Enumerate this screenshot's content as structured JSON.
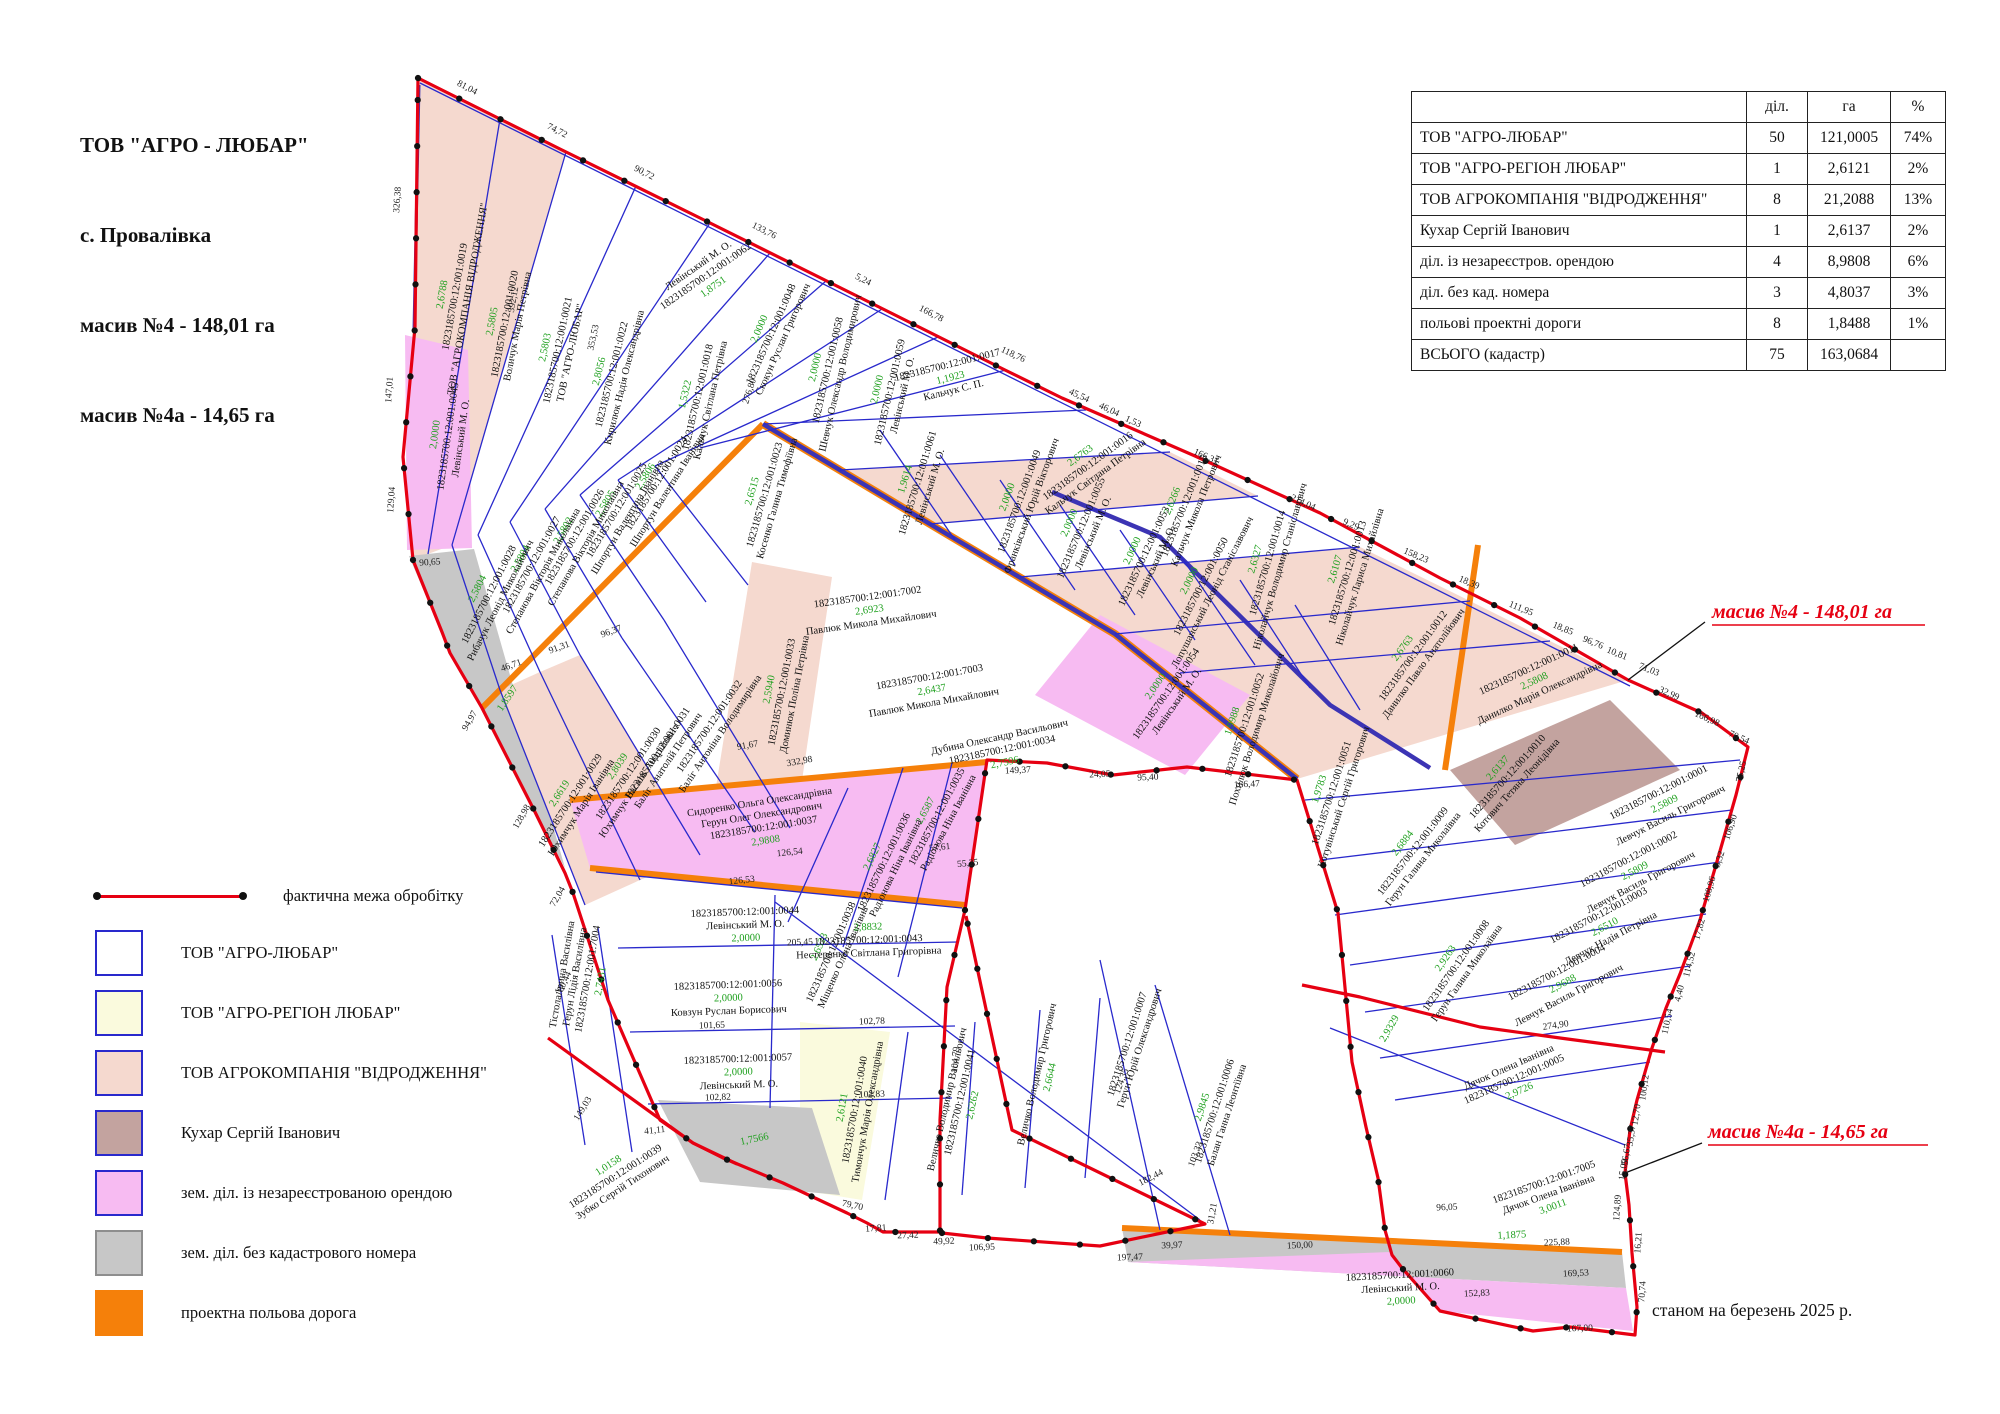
{
  "title_block": {
    "company": "ТОВ \"АГРО - ЛЮБАР\"",
    "village": "с. Провалівка",
    "massif4": "масив №4 - 148,01 га",
    "massif4a": "масив №4а - 14,65 га"
  },
  "summary_table": {
    "columns": [
      "діл.",
      "га",
      "%"
    ],
    "rows": [
      {
        "name": "ТОВ \"АГРО-ЛЮБАР\"",
        "plots": "50",
        "area": "121,0005",
        "pct": "74%"
      },
      {
        "name": "ТОВ \"АГРО-РЕГІОН ЛЮБАР\"",
        "plots": "1",
        "area": "2,6121",
        "pct": "2%"
      },
      {
        "name": "ТОВ АГРОКОМПАНІЯ \"ВІДРОДЖЕННЯ\"",
        "plots": "8",
        "area": "21,2088",
        "pct": "13%"
      },
      {
        "name": "Кухар Сергій Іванович",
        "plots": "1",
        "area": "2,6137",
        "pct": "2%"
      },
      {
        "name": "діл. із незареєстров. орендою",
        "plots": "4",
        "area": "8,9808",
        "pct": "6%"
      },
      {
        "name": "діл. без кад. номера",
        "plots": "3",
        "area": "4,8037",
        "pct": "3%"
      },
      {
        "name": "польові проектні дороги",
        "plots": "8",
        "area": "1,8488",
        "pct": "1%"
      },
      {
        "name": "ВСЬОГО (кадастр)",
        "plots": "75",
        "area": "163,0684",
        "pct": ""
      }
    ]
  },
  "legend": {
    "line_item": "фактична межа обробітку",
    "items": [
      {
        "label": "ТОВ \"АГРО-ЛЮБАР\"",
        "color": "#ffffff",
        "border": "#2929cc"
      },
      {
        "label": "ТОВ \"АГРО-РЕГІОН ЛЮБАР\"",
        "color": "#fafadd",
        "border": "#2929cc"
      },
      {
        "label": "ТОВ АГРОКОМПАНІЯ \"ВІДРОДЖЕННЯ\"",
        "color": "#f5d9cf",
        "border": "#2929cc"
      },
      {
        "label": "Кухар Сергій Іванович",
        "color": "#c3a39f",
        "border": "#2929cc"
      },
      {
        "label": "зем. діл. із незареєстрованою орендою",
        "color": "#f7bbf2",
        "border": "#2929cc"
      },
      {
        "label": "зем. діл. без кадастрового номера",
        "color": "#c7c7c7",
        "border": "#8e8e8e"
      },
      {
        "label": "проектна польова дорога",
        "color": "#f5800a",
        "border": "#f5800a"
      }
    ]
  },
  "annotations": {
    "massif4_label": "масив №4 - 148,01 га",
    "massif4a_label": "масив №4а - 14,65 га",
    "date_note": "станом на березень 2025 р."
  },
  "colors": {
    "boundary": "#e60012",
    "parcel_line": "#2929cc",
    "road": "#f5800a",
    "vidrodzhennia": "#f5d9cf",
    "region": "#fafadd",
    "kuhar": "#c3a39f",
    "unreg": "#f7bbf2",
    "nocad": "#c7c7c7",
    "area_text": "#1fa01f"
  },
  "parcels": [
    {
      "id": "1823185700:12:001:0019",
      "owner": "ТОВ \"АГРОКОМПАНІЯ ВІДРОДЖЕННЯ\"",
      "area": "2,6788",
      "cat": "vidrodzhennia"
    },
    {
      "id": "1823185700:12:001:0020",
      "owner": "Воличук Марія Петрівна",
      "area": "2,5805",
      "cat": "vidrodzhennia"
    },
    {
      "id": "1823185700:12:001:0021",
      "owner": "ТОВ \"АГРО-ЛЮБАР\"",
      "area": "2,5803",
      "cat": "lyubar"
    },
    {
      "id": "1823185700:12:001:0022",
      "owner": "Кирилюк Надія Олександрівна",
      "area": "2,8056",
      "cat": "lyubar"
    },
    {
      "id": "1823185700:12:001:0062",
      "owner": "Левінський М. О.",
      "area": "1,8751",
      "cat": "lyubar"
    },
    {
      "id": "1823185700:12:001:0048",
      "owner": "Скокун Руслан Григорович",
      "area": "2,0000",
      "cat": "lyubar"
    },
    {
      "id": "1823185700:12:001:0058",
      "owner": "Шевчук Олександр Володимирович",
      "area": "2,0000",
      "cat": "lyubar"
    },
    {
      "id": "1823185700:12:001:0059",
      "owner": "Левінський М. О.",
      "area": "2,0000",
      "cat": "lyubar"
    },
    {
      "id": "1823185700:12:001:0017",
      "owner": "Кальчук С. П.",
      "area": "1,1923",
      "cat": "lyubar"
    },
    {
      "id": "1823185700:12:001:0016",
      "owner": "Кальчук Світлана Петрівна",
      "area": "2,6763",
      "cat": "lyubar"
    },
    {
      "id": "1823185700:12:001:0015",
      "owner": "Кальчук Микола Петрович",
      "area": "2,6266",
      "cat": "lyubar"
    },
    {
      "id": "1823185700:12:001:0014",
      "owner": "Ніколайчук Володимир Станіславович",
      "area": "2,6327",
      "cat": "vidrodzhennia"
    },
    {
      "id": "1823185700:12:001:0013",
      "owner": "Ніколайчук Лариса Михайлівна",
      "area": "2,6107",
      "cat": "lyubar"
    },
    {
      "id": "1823185700:12:001:0012",
      "owner": "Данилко Павло Анатолійович",
      "area": "2,6763",
      "cat": "vidrodzhennia"
    },
    {
      "id": "1823185700:12:001:0011",
      "owner": "Данилко Марія Олександрівна",
      "area": "2,5808",
      "cat": "vidrodzhennia"
    },
    {
      "id": "1823185700:12:001:0010",
      "owner": "Котович Тетяна Леонідівна",
      "area": "2,6137",
      "cat": "kuhar"
    },
    {
      "id": "1823185700:12:001:0018",
      "owner": "Кальчук Світлана Петрівна",
      "area": "1,5322",
      "cat": "lyubar"
    },
    {
      "id": "1823185700:12:001:0024",
      "owner": "Шпортун Валентина Іванівна",
      "area": "2,5806",
      "cat": "lyubar"
    },
    {
      "id": "1823185700:12:001:0025",
      "owner": "Шпортун Валентина Іванівна",
      "area": "2,5805",
      "cat": "lyubar"
    },
    {
      "id": "1823185700:12:001:0026",
      "owner": "Степанова Вікторія Миколаївна",
      "area": "2,5802",
      "cat": "lyubar"
    },
    {
      "id": "1823185700:12:001:0027",
      "owner": "Степанова Вікторія Миколаївна",
      "area": "2,5804",
      "cat": "lyubar"
    },
    {
      "id": "1823185700:12:001:0028",
      "owner": "Рибачук Леонід Миколайович",
      "area": "2,5804",
      "cat": "lyubar"
    },
    {
      "id": "1823185700:12:001:0023",
      "owner": "Косенко Галина Тимофіївна",
      "area": "2,6515",
      "cat": "lyubar"
    },
    {
      "id": "1823185700:12:001:0045",
      "owner": "Левінський М. О.",
      "area": "2,0000",
      "cat": "unreg"
    },
    {
      "id": "",
      "owner": "",
      "area": "1,8597",
      "cat": "nocad"
    },
    {
      "id": "1823185700:12:001:0029",
      "owner": "Юхимчук Марія Іванівна",
      "area": "2,6619",
      "cat": "vidrodzhennia"
    },
    {
      "id": "1823185700:12:001:0030",
      "owner": "Юхимчук Василь Андрійович",
      "area": "2,8039",
      "cat": "vidrodzhennia"
    },
    {
      "id": "1823185700:12:001:0031",
      "owner": "Баліг Анатолій Петрович",
      "area": "",
      "cat": "lyubar"
    },
    {
      "id": "1823185700:12:001:0032",
      "owner": "Баліг Антоніна Володимирівна",
      "area": "",
      "cat": "lyubar"
    },
    {
      "id": "1823185700:12:001:0033",
      "owner": "Доминюк Поліна Петрівна",
      "area": "2,5940",
      "cat": "vidrodzhennia"
    },
    {
      "id": "1823185700:12:001:7002",
      "owner": "Павлюк Микола Михайлович",
      "area": "2,6923",
      "cat": "lyubar"
    },
    {
      "id": "1823185700:12:001:7003",
      "owner": "Павлюк Микола Михайлович",
      "area": "2,6437",
      "cat": "lyubar"
    },
    {
      "id": "1823185700:12:001:0034",
      "owner": "Дубина Олександр Васильович",
      "area": "2,7596",
      "cat": "lyubar"
    },
    {
      "id": "1823185700:12:001:0061",
      "owner": "Левінський М. О.",
      "area": "1,9614",
      "cat": "lyubar"
    },
    {
      "id": "1823185700:12:001:0049",
      "owner": "Франківський Юрій Вікторович",
      "area": "2,0000",
      "cat": "lyubar"
    },
    {
      "id": "1823185700:12:001:0055",
      "owner": "Левінський М. О.",
      "area": "2,0000",
      "cat": "lyubar"
    },
    {
      "id": "1823185700:12:001:0053",
      "owner": "Левінський М. О.",
      "area": "2,0000",
      "cat": "lyubar"
    },
    {
      "id": "1823185700:12:001:0050",
      "owner": "Лопушанський Леонід Станіславович",
      "area": "2,0000",
      "cat": "lyubar"
    },
    {
      "id": "1823185700:12:001:0054",
      "owner": "Левінський М. О.",
      "area": "2,0000",
      "cat": "unreg"
    },
    {
      "id": "1823185700:12:001:0052",
      "owner": "Похилюк Володимир Миколайович",
      "area": "1,9988",
      "cat": "lyubar"
    },
    {
      "id": "1823185700:12:001:0051",
      "owner": "Котувінський Сергій Григорович",
      "area": "1,9783",
      "cat": "lyubar"
    },
    {
      "id": "1823185700:12:001:0037",
      "owner": "Сидоренко Ольга Олександрівна",
      "owner2": "Герун Олег Олександрович",
      "area": "2,9808",
      "cat": "unreg"
    },
    {
      "id": "1823185700:12:001:0035",
      "owner": "Радіонова Ніна Іванівна",
      "area": "2,6587",
      "cat": "lyubar"
    },
    {
      "id": "1823185700:12:001:0036",
      "owner": "Радіонова Ніна Іванівна",
      "area": "2,6827",
      "cat": "lyubar"
    },
    {
      "id": "1823185700:12:001:0038",
      "owner": "Міщенко Олена Іванівна",
      "area": "2,6523",
      "cat": "lyubar"
    },
    {
      "id": "1823185700:12:001:0044",
      "owner": "Левінський М. О.",
      "area": "2,0000",
      "cat": "lyubar"
    },
    {
      "id": "1823185700:12:001:0056",
      "owner": "Ковзун Руслан Борисович",
      "area": "2,0000",
      "cat": "lyubar"
    },
    {
      "id": "1823185700:12:001:0057",
      "owner": "Левінський М. О.",
      "area": "2,0000",
      "cat": "lyubar"
    },
    {
      "id": "1823185700:12:001:7004",
      "owner": "Тістола Ірина Василівна",
      "owner2": "Герун Лідія Василівна",
      "area": "2,7431",
      "cat": "lyubar"
    },
    {
      "id": "1823185700:12:001:0039",
      "owner": "Зубко Сергій Тихонович",
      "area": "1,0158",
      "cat": "lyubar"
    },
    {
      "id": "",
      "owner": "",
      "area": "1,7566",
      "cat": "nocad"
    },
    {
      "id": "1823185700:12:001:0040",
      "owner": "Тимончук Марія Олександрівна",
      "area": "2,6121",
      "cat": "region"
    },
    {
      "id": "1823185700:12:001:0041",
      "owner": "Величко Володимир Васильович",
      "area": "2,6262",
      "cat": "lyubar"
    },
    {
      "id": "",
      "owner": "Величко Володимир Григорович",
      "area": "2,6644",
      "cat": "lyubar"
    },
    {
      "id": "1823185700:12:001:0043",
      "owner": "Нестеренко Світлана Григорівна",
      "area": "2,8832",
      "cat": "lyubar"
    },
    {
      "id": "1823185700:12:001:0009",
      "owner": "Герун Галина Миколаївна",
      "area": "2,6884",
      "cat": "lyubar"
    },
    {
      "id": "1823185700:12:001:0008",
      "owner": "Герун Галина Миколаївна",
      "area": "2,9263",
      "cat": "lyubar"
    },
    {
      "id": "1823185700:12:001:0001",
      "owner": "Левчук Василь Григорович",
      "area": "2,5809",
      "cat": "lyubar"
    },
    {
      "id": "1823185700:12:001:0002",
      "owner": "Левчук Василь Григорович",
      "area": "2,5809",
      "cat": "lyubar"
    },
    {
      "id": "1823185700:12:001:0003",
      "owner": "Левчук Надія Петрівна",
      "area": "2,6510",
      "cat": "lyubar"
    },
    {
      "id": "1823185700:12:001:0004",
      "owner": "Левчук Василь Григорович",
      "area": "2,9688",
      "cat": "lyubar"
    },
    {
      "id": "1823185700:12:001:0005",
      "owner": "Дячок Олена Іванівна",
      "area": "2,9726",
      "cat": "lyubar"
    },
    {
      "id": "1823185700:12:001:7005",
      "owner": "Дячок Олена Іванівна",
      "area": "3,0011",
      "cat": "lyubar"
    },
    {
      "id": "1823185700:12:001:0006",
      "owner": "Балан Ганна Леонтіївна",
      "area": "2,9845",
      "cat": "lyubar"
    },
    {
      "id": "1823185700:12:001:0007",
      "owner": "Герун Юрій Олександрович",
      "area": "",
      "cat": "lyubar"
    },
    {
      "id": "",
      "owner": "",
      "area": "2,9329",
      "cat": "lyubar"
    },
    {
      "id": "1823185700:12:001:0060",
      "owner": "Левінський М. О.",
      "area": "2,0000",
      "cat": "unreg"
    },
    {
      "id": "",
      "owner": "",
      "area": "1,1875",
      "cat": "nocad"
    }
  ],
  "edge_lengths": [
    "81,04",
    "74,72",
    "90,72",
    "133,76",
    "5,24",
    "166,78",
    "118,76",
    "45,54",
    "46,04",
    "1,53",
    "166,31",
    "214,04",
    "9,29",
    "158,23",
    "18,39",
    "111,95",
    "18,85",
    "96,76",
    "10,81",
    "71,03",
    "32,99",
    "166,98",
    "70,54",
    "75,25",
    "106,90",
    "3,32",
    "108,96",
    "17,82",
    "114,52",
    "4,40",
    "110,54",
    "100,12",
    "12,70",
    "35,37",
    "56,67",
    "15,09",
    "124,89",
    "16,21",
    "70,74",
    "167,00",
    "152,83",
    "31,21",
    "39,97",
    "197,47",
    "182,44",
    "106,95",
    "49,92",
    "27,42",
    "17,81",
    "79,70",
    "41,11",
    "149,03",
    "180,44",
    "72,04",
    "128,98",
    "94,97",
    "90,65",
    "129,04",
    "147,01",
    "326,38",
    "124,35",
    "103,33",
    "96,05",
    "150,00",
    "225,88",
    "169,53",
    "149,37",
    "24,05",
    "95,40",
    "166,47",
    "274,90",
    "46,71",
    "91,31",
    "96,37",
    "332,98",
    "91,67",
    "126,54",
    "126,53",
    "57,61",
    "55,25",
    "205,45",
    "101,65",
    "102,78",
    "102,82",
    "102,83",
    "104,79",
    "392,12",
    "353,53",
    "276,80"
  ]
}
